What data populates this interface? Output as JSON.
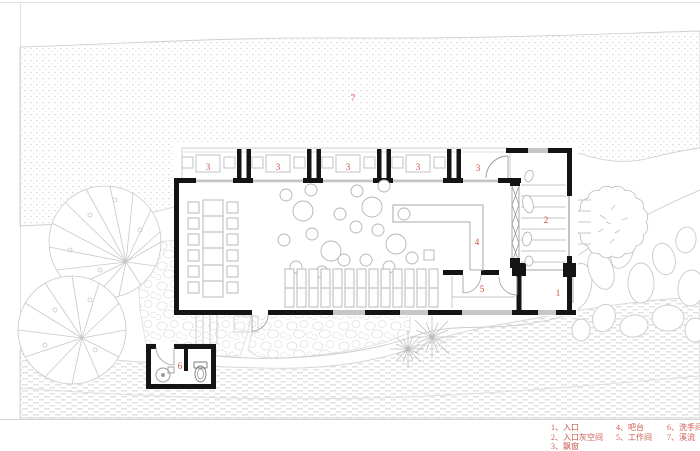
{
  "palette": {
    "wall_black": "#141414",
    "label_red": "#d14b41",
    "legend_red": "#cd5a52",
    "landscape_line": "#c9c9c9"
  },
  "rooms": [
    {
      "number": "1",
      "name": "入口"
    },
    {
      "number": "2",
      "name": "入口灰空间"
    },
    {
      "number": "3",
      "name": "飘窗"
    },
    {
      "number": "4",
      "name": "吧台"
    },
    {
      "number": "5",
      "name": "工作间"
    },
    {
      "number": "6",
      "name": "洗手间"
    },
    {
      "number": "7",
      "name": "溪流"
    }
  ],
  "plan": {
    "labels": {
      "l1": "1",
      "l2": "2",
      "l3": "3",
      "l4": "4",
      "l5": "5",
      "l6": "6",
      "l7": "7"
    }
  },
  "legend": {
    "columns": [
      [
        "1、入口",
        "2、入口灰空间",
        "3、飘窗"
      ],
      [
        "4、吧台",
        "5、工作间"
      ],
      [
        "6、洗手间",
        "7、溪流"
      ]
    ]
  }
}
